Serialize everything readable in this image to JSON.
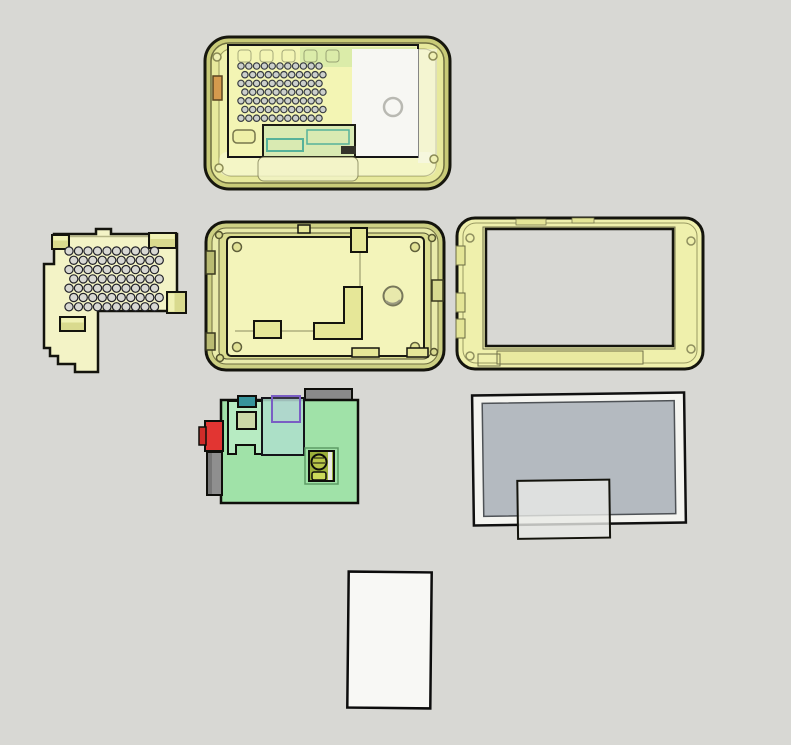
{
  "viewport": {
    "background": "#d8d8d4",
    "kind": "3d-cad-exploded-view"
  },
  "parts": [
    {
      "id": "assembled-case",
      "label": "assembled translucent case (top view)",
      "rim": "#c9cb78",
      "body": "#e7e99c",
      "face": "#f0f2ae",
      "panel": "#f3f5b4",
      "white_panel": "#f7f7f3",
      "sd_card": "#d59a4e",
      "outline": "#17170e"
    },
    {
      "id": "vent-plate",
      "label": "L-shaped vented mounting plate",
      "body": "#f3f3c6",
      "tab": "#d9da8e",
      "tab_top": "#f0f1b4",
      "outline": "#14140d"
    },
    {
      "id": "case-tray",
      "label": "case mid tray / back shell",
      "rim": "#cdd083",
      "inner_rim": "#e9ebaa",
      "wall_shadow": "#dcde90",
      "floor": "#f3f4ba",
      "wall": "#e6e798",
      "boss": "#e2e396",
      "port": "#b9bb72",
      "outline": "#14140d"
    },
    {
      "id": "front-bezel",
      "label": "front bezel frame with screen window",
      "body": "#eff0ac",
      "window": "#d8d8d4",
      "notch": "#e4e596",
      "recess": "#e9eaa0",
      "outline": "#14140d"
    },
    {
      "id": "pcb",
      "label": "single-board computer PCB",
      "body": "#a0e2a8",
      "daughter": "#b7ebc2",
      "overlay": "rgba(174,223,205,0.85)",
      "teal_chip": "#37949b",
      "olive_chip": "#ccd9a8",
      "header": "#8a8a8a",
      "jack": "#e23532",
      "jack_dark": "#cf2c29",
      "port": "#8f8f8f",
      "accent": "#7a5ec4",
      "component": "#9caf3a",
      "component_cap": "#b9c74a",
      "component_pad": "#ccd95a",
      "outline": "#0e0e0a"
    },
    {
      "id": "lcd",
      "label": "LCD display panel with driver flex",
      "frame": "#f4f4f0",
      "screen": "#b4bac0",
      "flex": "rgba(233,234,230,0.8)",
      "outline": "#101010"
    },
    {
      "id": "blank-card",
      "label": "blank card / diffuser sheet",
      "body": "#f8f8f5",
      "outline": "#0c0c0c"
    }
  ],
  "vents": [
    {
      "target": "case-vent-holes",
      "x0": 241,
      "y0": 66,
      "dx": 7.8,
      "dy": 8.7,
      "cols": 11,
      "rows": 7,
      "stagger": 3.9,
      "r": 3.2,
      "fill": "#ccd0cc",
      "stroke": "#383c42"
    },
    {
      "target": "plate-vent-holes",
      "x0": 69,
      "y0": 251,
      "dx": 9.5,
      "dy": 9.3,
      "cols": 10,
      "rows": 7,
      "stagger": 4.75,
      "r": 4.1,
      "fill": "#d8d8d3",
      "stroke": "#22222a"
    }
  ]
}
